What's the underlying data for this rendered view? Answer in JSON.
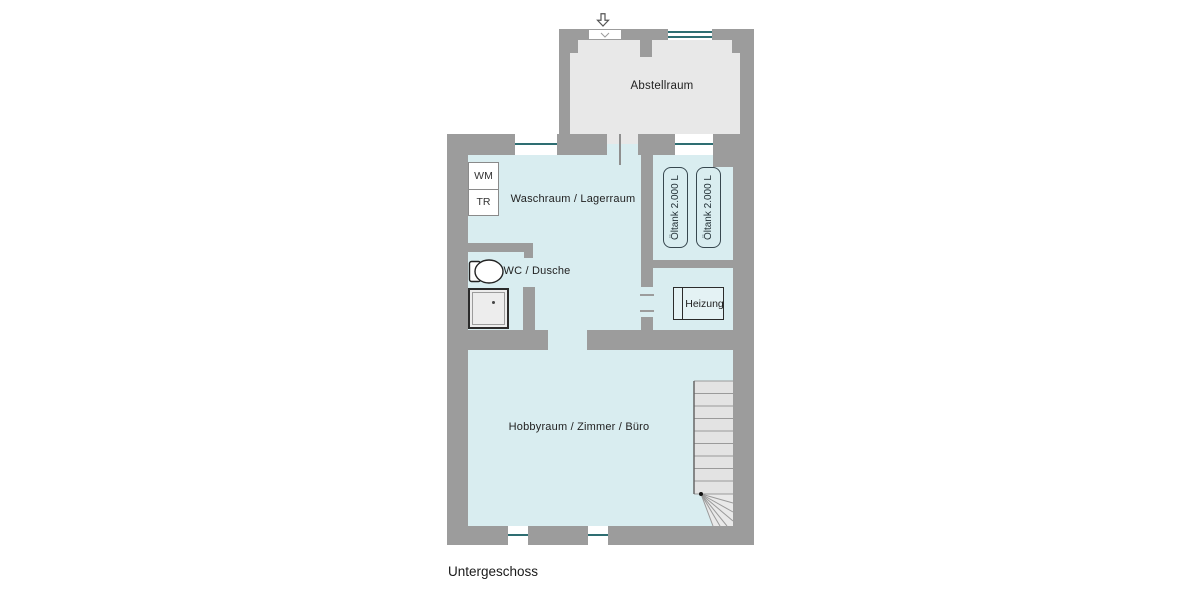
{
  "floor_label": "Untergeschoss",
  "colors": {
    "wall": "#9c9c9c",
    "room_fill": "#d9edf0",
    "storage_fill": "#e8e8e8",
    "window_glass": "#2e6e72",
    "fixture_outline": "#2b2b2b",
    "tank_outline": "#37474f",
    "stair_fill": "#e3e3e3",
    "stair_line": "#9a9a9a",
    "text": "#222222",
    "background": "#ffffff"
  },
  "rooms": {
    "abstellraum": {
      "label": "Abstellraum"
    },
    "waschraum": {
      "label": "Waschraum / Lagerraum"
    },
    "wc": {
      "label": "WC / Dusche"
    },
    "heizung": {
      "label": "Heizung"
    },
    "hobbyraum": {
      "label": "Hobbyraum / Zimmer / Büro"
    }
  },
  "fixtures": {
    "washing_machine": {
      "label": "WM"
    },
    "dryer": {
      "label": "TR"
    },
    "oil_tanks": [
      {
        "label": "Öltank 2.000 L"
      },
      {
        "label": "Öltank 2.000 L"
      }
    ]
  },
  "icons": {
    "entrance_arrow": "entrance-arrow-down"
  }
}
